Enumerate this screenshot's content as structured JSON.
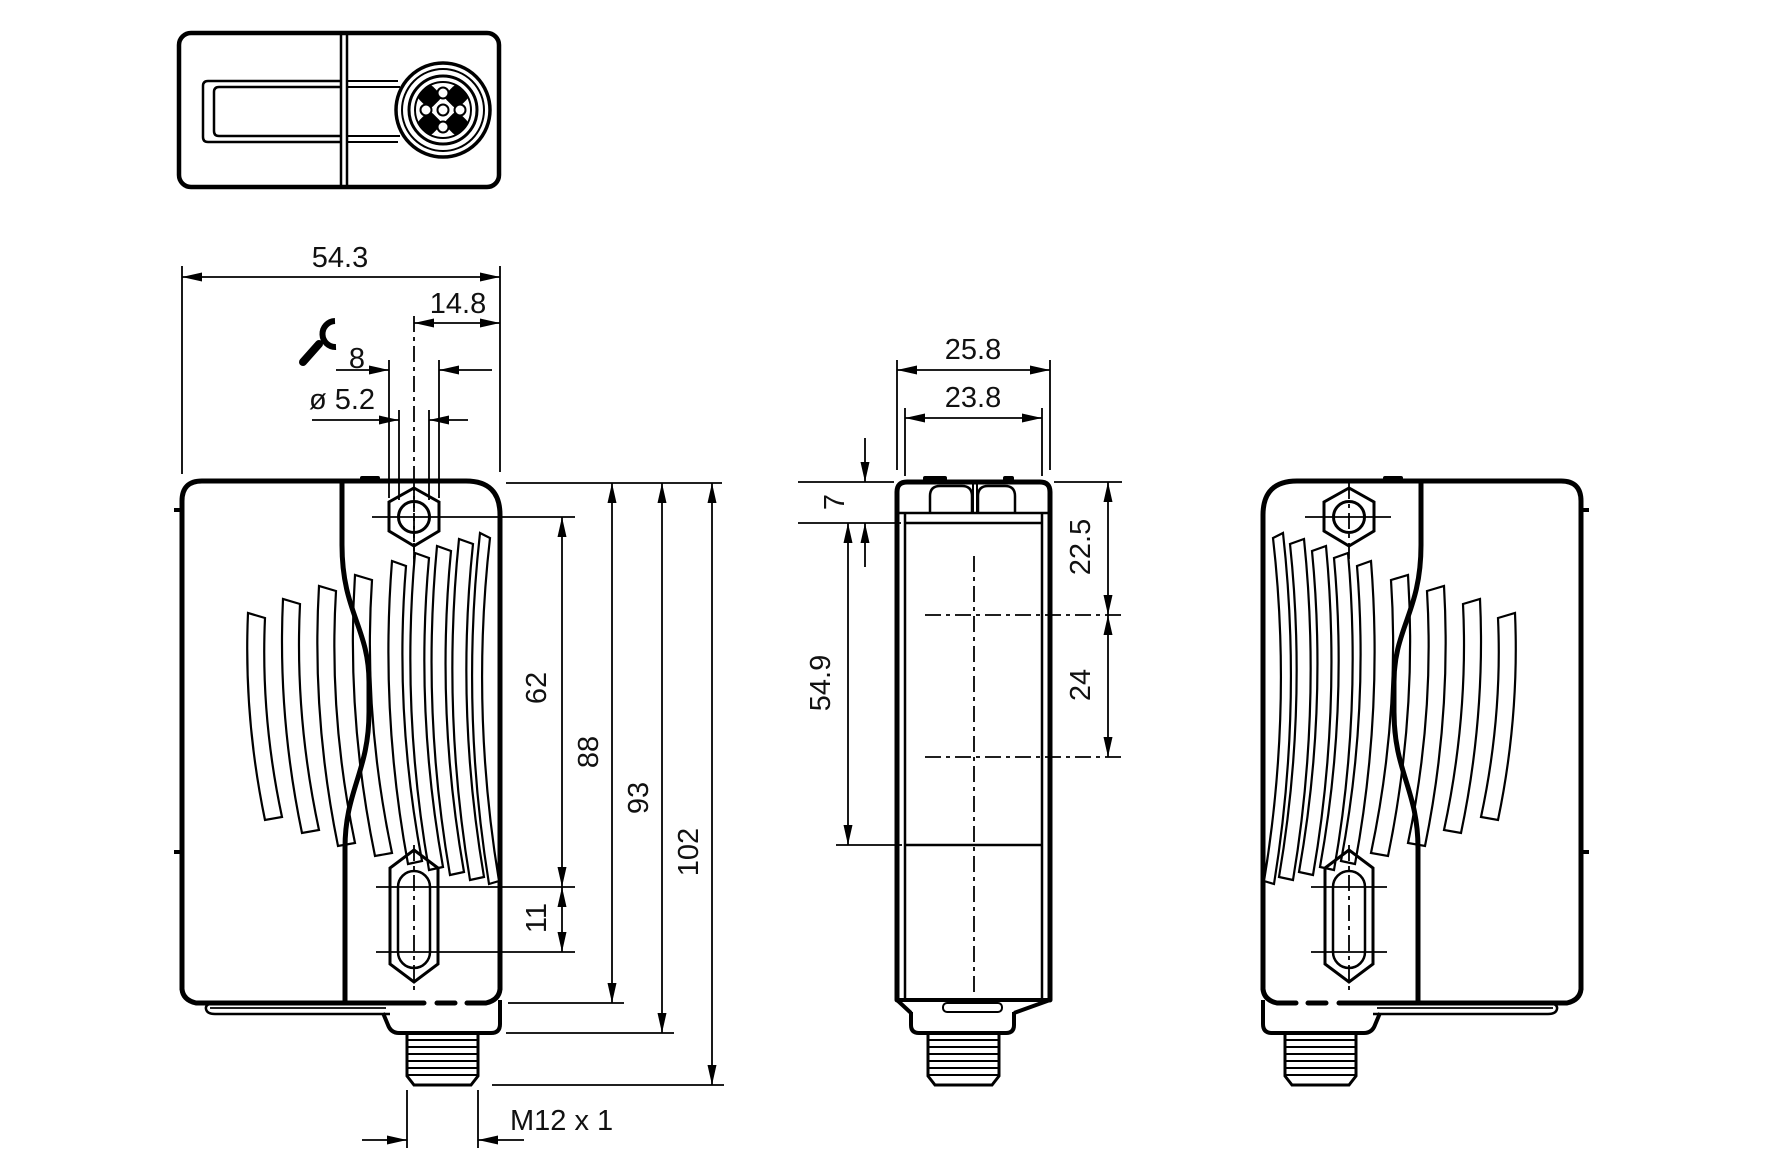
{
  "colors": {
    "line": "#000000",
    "background": "#ffffff"
  },
  "icons": {
    "wrench": "wrench-icon"
  },
  "dims": {
    "overall_width": "54.3",
    "connector_offset": "14.8",
    "wrench_size": "8",
    "hole_diameter": "ø 5.2",
    "hole_center_span": "62",
    "body_height": "88",
    "body_with_collar": "93",
    "total_height": "102",
    "slot_length": "11",
    "thread": "M12 x 1",
    "depth_overall": "25.8",
    "face_width": "23.8",
    "head_height": "7",
    "face_height": "54.9",
    "top_hole_offset": "22.5",
    "hole_spacing": "24"
  }
}
